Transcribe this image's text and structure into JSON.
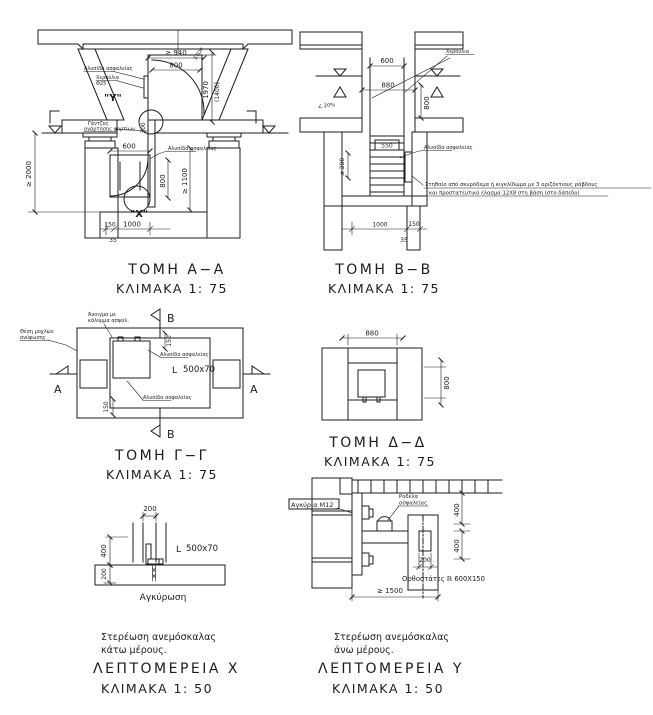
{
  "page": {
    "bg": "#ffffff",
    "ink": "#1c1c1c"
  },
  "aa": {
    "title": "ΤΟΜΗ  Α−Α",
    "scale": "ΚΛΙΜΑΚΑ  1: 75",
    "labels": {
      "chain_top": "Αλυσίδα ασφαλείας",
      "handles1": "Χερούλια",
      "handles2": "Φ25",
      "y_mark": "\"Υ\"",
      "stop": "STOP",
      "hook1": "Γάντζος",
      "hook2": "ανάρτησης φορτίων",
      "chain_mid": "Αλυσίδα ασφαλείας",
      "x_mark": "\"Χ\""
    },
    "dims": {
      "d940": "≥ 940",
      "d800_top": "800",
      "d1970": "1970",
      "d1400": "(1400)",
      "d300": "300",
      "d2000": "≥ 2000",
      "d600": "600",
      "d800_low": "800",
      "d1100": "≥ 1100",
      "d150": "150",
      "d1000": "1000",
      "d35": "35"
    }
  },
  "bb": {
    "title": "ΤΟΜΗ  Β−Β",
    "scale": "ΚΛΙΜΑΚΑ  1: 75",
    "labels": {
      "handles": "Χερούλια",
      "slope": "∠ 20%",
      "chain": "Αλυσίδα ασφαλείας",
      "note1": "Στηθαίο από σκυρόδεμα ή κιγκλίδωμα με 3 οριζόντιους ράβδους",
      "note2": "και προστατευτικό έλασμα 12Χ8 στη βάση (στο δάπεδο)"
    },
    "dims": {
      "d600": "600",
      "d880": "880",
      "d800": "800",
      "d550": "550",
      "d280": "≤ 280",
      "d1000": "1000",
      "d150": "150",
      "d35": "35"
    }
  },
  "gg": {
    "title": "ΤΟΜΗ  Γ−Γ",
    "scale": "ΚΛΙΜΑΚΑ  1: 75",
    "labels": {
      "levers1": "Θέση μοχλών",
      "levers2": "ανύψωσης",
      "opening1": "Άνοιγμα με",
      "opening2": "κάλυμμα ασφαλ.",
      "chain1": "Αλυσίδα ασφαλείας",
      "chain2": "Αλυσίδα ασφαλείας",
      "angle_glyph": "L",
      "angle": "500x70",
      "a": "Α",
      "b": "Β"
    },
    "dims": {
      "d150_top": "150",
      "d150_bot": "150"
    }
  },
  "dd": {
    "title": "ΤΟΜΗ  Δ−Δ",
    "scale": "ΚΛΙΜΑΚΑ  1: 75",
    "dims": {
      "d880": "880",
      "d800": "800"
    }
  },
  "dx": {
    "title": "ΛΕΠΤΟΜΕΡΕΙΑ  Χ",
    "scale": "ΚΛΙΜΑΚΑ  1: 50",
    "caption1": "Στερέωση ανεμόσκαλας",
    "caption2": "κάτω μέρους.",
    "labels": {
      "angle_glyph": "L",
      "angle": "500x70",
      "anchoring": "Αγκύρωση"
    },
    "dims": {
      "d200_top": "200",
      "d400": "400",
      "d200_ground": "200"
    }
  },
  "dy": {
    "title": "ΛΕΠΤΟΜΕΡΕΙΑ  Υ",
    "scale": "ΚΛΙΜΑΚΑ  1: 50",
    "caption1": "Στερέωση ανεμόσκαλας",
    "caption2": "άνω μέρους.",
    "labels": {
      "anchors": "Αγκύρια Μ12",
      "washer1": "Ροδέλα",
      "washer2": "ασφαλείας",
      "uprights": "Ορθοστάτες ℝ 600Χ150"
    },
    "dims": {
      "d400_top": "400",
      "d400_bot": "400",
      "d200": "200",
      "d1500": "≥ 1500"
    }
  }
}
